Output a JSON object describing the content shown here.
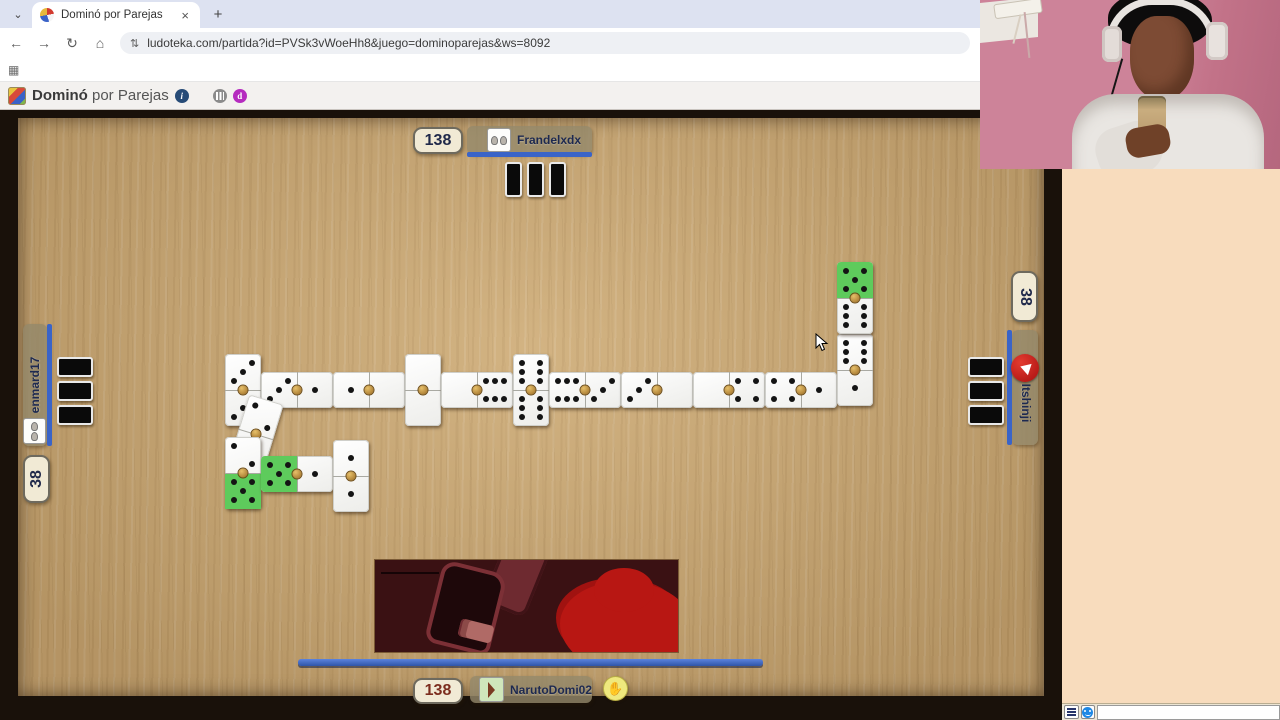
{
  "browser": {
    "tab_chevron": "⌄",
    "tab_title": "Dominó por Parejas",
    "tab_close": "×",
    "new_tab": "+",
    "back": "←",
    "forward": "→",
    "reload": "↻",
    "home": "⌂",
    "tune": "⇅",
    "url": "ludoteka.com/partida?id=PVSk3vWoeHh8&juego=dominoparejas&ws=8092",
    "apps": "▦"
  },
  "header": {
    "title": "Dominó",
    "subtitle": "por Parejas",
    "info_glyph": "i",
    "brand_glyph": "d"
  },
  "players": {
    "top": {
      "name": "Frandelxdx",
      "score": "138",
      "hidden_tiles": 3
    },
    "bottom": {
      "name": "NarutoDomi02",
      "score": "138",
      "hand_glyph": "✋"
    },
    "left": {
      "name": "enmard17",
      "score": "38",
      "hidden_tiles": 3
    },
    "right": {
      "name": "Itshinji",
      "score": "38",
      "hidden_tiles": 3
    }
  },
  "board": {
    "tiles": [
      {
        "x": 225,
        "y": 354,
        "o": "v",
        "v": [
          3,
          3
        ],
        "green": [
          false,
          false
        ],
        "rot": 0
      },
      {
        "x": 261,
        "y": 372,
        "o": "h",
        "v": [
          3,
          1
        ],
        "green": [
          false,
          false
        ],
        "rot": 0
      },
      {
        "x": 333,
        "y": 372,
        "o": "h",
        "v": [
          1,
          0
        ],
        "green": [
          false,
          false
        ],
        "rot": 0
      },
      {
        "x": 405,
        "y": 354,
        "o": "v",
        "v": [
          0,
          0
        ],
        "green": [
          false,
          false
        ],
        "rot": 0
      },
      {
        "x": 441,
        "y": 372,
        "o": "h",
        "v": [
          0,
          6
        ],
        "green": [
          false,
          false
        ],
        "rot": 0
      },
      {
        "x": 513,
        "y": 354,
        "o": "v",
        "v": [
          6,
          6
        ],
        "green": [
          false,
          false
        ],
        "rot": 0
      },
      {
        "x": 549,
        "y": 372,
        "o": "h",
        "v": [
          6,
          3
        ],
        "green": [
          false,
          false
        ],
        "rot": 0
      },
      {
        "x": 621,
        "y": 372,
        "o": "h",
        "v": [
          3,
          0
        ],
        "green": [
          false,
          false
        ],
        "rot": 0
      },
      {
        "x": 693,
        "y": 372,
        "o": "h",
        "v": [
          0,
          4
        ],
        "green": [
          false,
          false
        ],
        "rot": 0
      },
      {
        "x": 765,
        "y": 372,
        "o": "h",
        "v": [
          4,
          1
        ],
        "green": [
          false,
          false
        ],
        "rot": 0
      },
      {
        "x": 837,
        "y": 334,
        "o": "v",
        "v": [
          6,
          1
        ],
        "green": [
          false,
          false
        ],
        "rot": 0
      },
      {
        "x": 837,
        "y": 262,
        "o": "v",
        "v": [
          5,
          6
        ],
        "green": [
          true,
          false
        ],
        "rot": 0
      },
      {
        "x": 238,
        "y": 398,
        "o": "v",
        "v": [
          2,
          2
        ],
        "green": [
          false,
          false
        ],
        "rot": 17
      },
      {
        "x": 225,
        "y": 437,
        "o": "v",
        "v": [
          2,
          5
        ],
        "green": [
          false,
          true
        ],
        "rot": 0
      },
      {
        "x": 261,
        "y": 456,
        "o": "h",
        "v": [
          5,
          1
        ],
        "green": [
          true,
          false
        ],
        "rot": 0
      },
      {
        "x": 333,
        "y": 440,
        "o": "v",
        "v": [
          1,
          1
        ],
        "green": [
          false,
          false
        ],
        "rot": 0
      }
    ]
  },
  "colors": {
    "accent_blue": "#3a64c8",
    "highlight_green": "#5ecb5c",
    "wood": "#c9a56f",
    "score_navy": "#20294a",
    "score_red": "#7c2d1e"
  }
}
